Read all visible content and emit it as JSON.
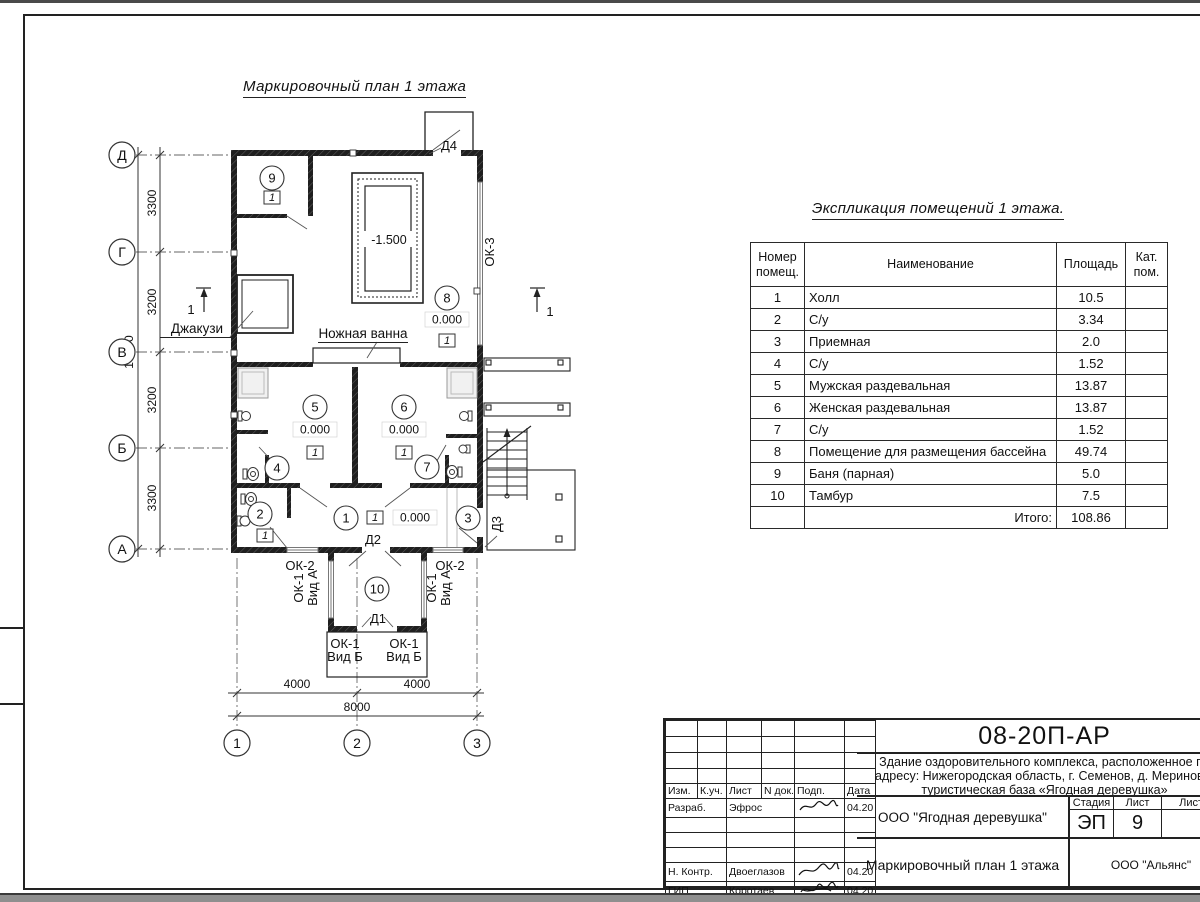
{
  "sheet": {
    "plan_title": "Маркировочный план 1 этажа",
    "axes_rows": [
      "Д",
      "Г",
      "В",
      "Б",
      "А"
    ],
    "axes_cols": [
      "1",
      "2",
      "3"
    ],
    "dims": {
      "seg1": "3300",
      "seg2": "3200",
      "seg3": "3200",
      "seg4": "3300",
      "left_total": "13000",
      "bot1": "4000",
      "bot2": "4000",
      "bot_total": "8000"
    },
    "labels": {
      "jacuzzi": "Джакузи",
      "foot_bath": "Ножная ванна",
      "pool_level": "-1.500",
      "level_zero": "0.000",
      "floor_type": "1",
      "section_mark": "1",
      "d1": "Д1",
      "d2": "Д2",
      "d3": "Д3",
      "d4": "Д4",
      "ok1": "ОК-1",
      "vid_a": "Вид А",
      "vid_b": "Вид Б",
      "ok2": "ОК-2",
      "ok3": "ОК-3"
    },
    "rooms": [
      "1",
      "2",
      "3",
      "4",
      "5",
      "6",
      "7",
      "8",
      "9",
      "10"
    ]
  },
  "expl": {
    "title": "Экспликация помещений 1 этажа.",
    "headers": [
      "Номер помещ.",
      "Наименование",
      "Площадь",
      "Кат. пом."
    ],
    "rows": [
      {
        "num": "1",
        "name": "Холл",
        "area": "10.5",
        "cat": ""
      },
      {
        "num": "2",
        "name": "С/у",
        "area": "3.34",
        "cat": ""
      },
      {
        "num": "3",
        "name": "Приемная",
        "area": "2.0",
        "cat": ""
      },
      {
        "num": "4",
        "name": "С/у",
        "area": "1.52",
        "cat": ""
      },
      {
        "num": "5",
        "name": "Мужская раздевальная",
        "area": "13.87",
        "cat": ""
      },
      {
        "num": "6",
        "name": "Женская раздевальная",
        "area": "13.87",
        "cat": ""
      },
      {
        "num": "7",
        "name": "С/у",
        "area": "1.52",
        "cat": ""
      },
      {
        "num": "8",
        "name": "Помещение для размещения бассейна",
        "area": "49.74",
        "cat": ""
      },
      {
        "num": "9",
        "name": "Баня (парная)",
        "area": "5.0",
        "cat": ""
      },
      {
        "num": "10",
        "name": "Тамбур",
        "area": "7.5",
        "cat": ""
      }
    ],
    "total_label": "Итого:",
    "total_value": "108.86"
  },
  "tb": {
    "code": "08-20П-АР",
    "proj1": "Здание оздоровительного комплекса, расположенное по",
    "proj2": "адресу: Нижегородская область, г. Семенов, д. Мериново,",
    "proj3": "туристическая база «Ягодная деревушка»",
    "client": "ООО \"Ягодная деревушка\"",
    "stage_label": "Стадия",
    "sheet_label": "Лист",
    "sheets_label": "Листов",
    "stage": "ЭП",
    "sheet_num": "9",
    "doc_title": "Маркировочный план 1 этажа",
    "org": "ООО \"Альянс\"",
    "cols": [
      "Изм.",
      "К.уч.",
      "Лист",
      "N док.",
      "Подп.",
      "Дата"
    ],
    "sign_rows": [
      {
        "role": "Разраб.",
        "name": "Эфрос",
        "date": "04.20"
      },
      {
        "role": "",
        "name": "",
        "date": ""
      },
      {
        "role": "",
        "name": "",
        "date": ""
      },
      {
        "role": "",
        "name": "",
        "date": ""
      },
      {
        "role": "Н. Контр.",
        "name": "Двоеглазов",
        "date": "04.20"
      },
      {
        "role": "ГИП",
        "name": "Коротаев",
        "date": "04.20"
      }
    ]
  }
}
